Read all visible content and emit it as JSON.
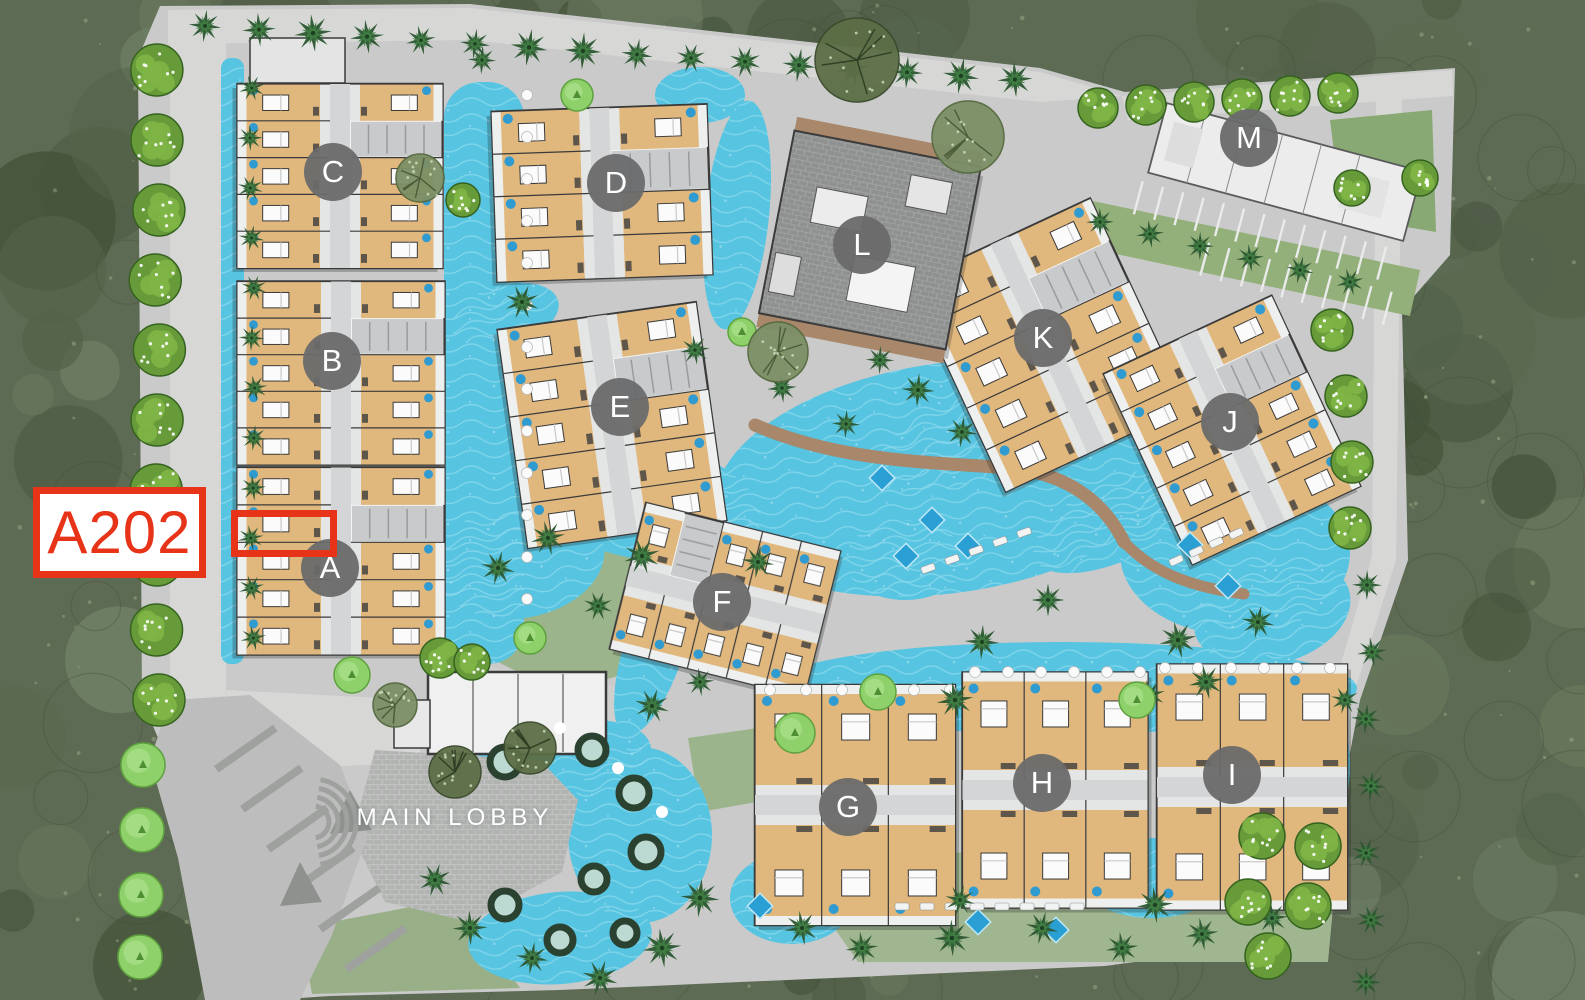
{
  "labels": {
    "main_lobby": "MAIN LOBBY"
  },
  "selection": {
    "unit_label": "A202",
    "building": "A",
    "callout_box": {
      "x": 33,
      "y": 487,
      "w": 173,
      "h": 91
    },
    "highlight_box": {
      "x": 231,
      "y": 510,
      "w": 106,
      "h": 47
    }
  },
  "buildings": [
    {
      "label": "A",
      "x": 330,
      "y": 568
    },
    {
      "label": "B",
      "x": 332,
      "y": 361
    },
    {
      "label": "C",
      "x": 333,
      "y": 172
    },
    {
      "label": "D",
      "x": 616,
      "y": 183
    },
    {
      "label": "E",
      "x": 620,
      "y": 407
    },
    {
      "label": "F",
      "x": 722,
      "y": 602
    },
    {
      "label": "G",
      "x": 848,
      "y": 807
    },
    {
      "label": "H",
      "x": 1042,
      "y": 783
    },
    {
      "label": "I",
      "x": 1232,
      "y": 775
    },
    {
      "label": "J",
      "x": 1230,
      "y": 422
    },
    {
      "label": "K",
      "x": 1043,
      "y": 338
    },
    {
      "label": "L",
      "x": 862,
      "y": 245
    },
    {
      "label": "M",
      "x": 1249,
      "y": 138
    }
  ],
  "colors": {
    "highlight_red": "#e73418",
    "marker_gray": "#6a6a6b",
    "water": "#57c4e1",
    "site_ground": "#c9cac9",
    "forest": "#5e6b54",
    "unit_tan": "#e0b77d",
    "lawn": "#9cb48b",
    "deck_brown": "#a8876a"
  }
}
